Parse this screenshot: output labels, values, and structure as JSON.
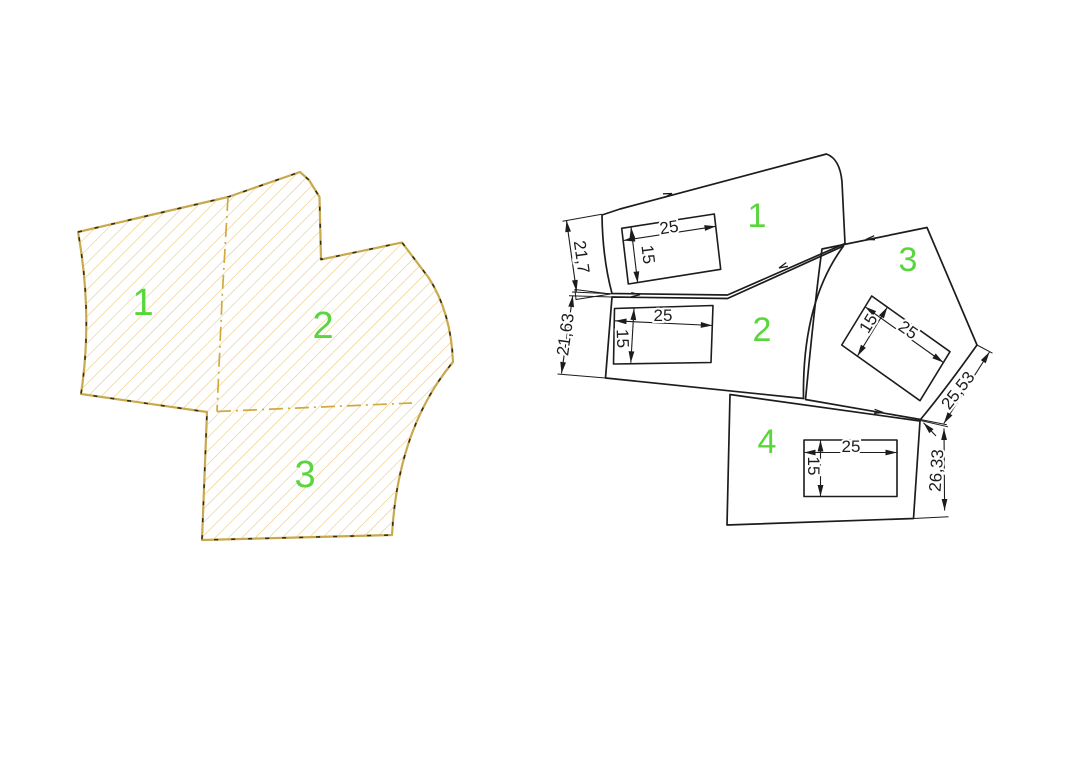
{
  "title": "cad-parts-drawing",
  "colors": {
    "background": "#ffffff",
    "outline": "#1c1c1c",
    "label_green": "#58D63C",
    "hatch": "#E8C87C",
    "gold": "#C9A94E",
    "dark_dash": "#2e2a18",
    "divider": "#D2A93E"
  },
  "left_figure": {
    "region_labels": [
      "1",
      "2",
      "3"
    ]
  },
  "right_figure": {
    "pieces": [
      {
        "label": "1",
        "rect_width": "25",
        "rect_height": "15",
        "edge_dim": "21,7"
      },
      {
        "label": "2",
        "rect_width": "25",
        "rect_height": "15",
        "edge_dim": "21,63"
      },
      {
        "label": "3",
        "rect_width": "25",
        "rect_height": "15",
        "edge_dim": "25,53"
      },
      {
        "label": "4",
        "rect_width": "25",
        "rect_height": "15",
        "edge_dim": "26,33"
      }
    ]
  }
}
